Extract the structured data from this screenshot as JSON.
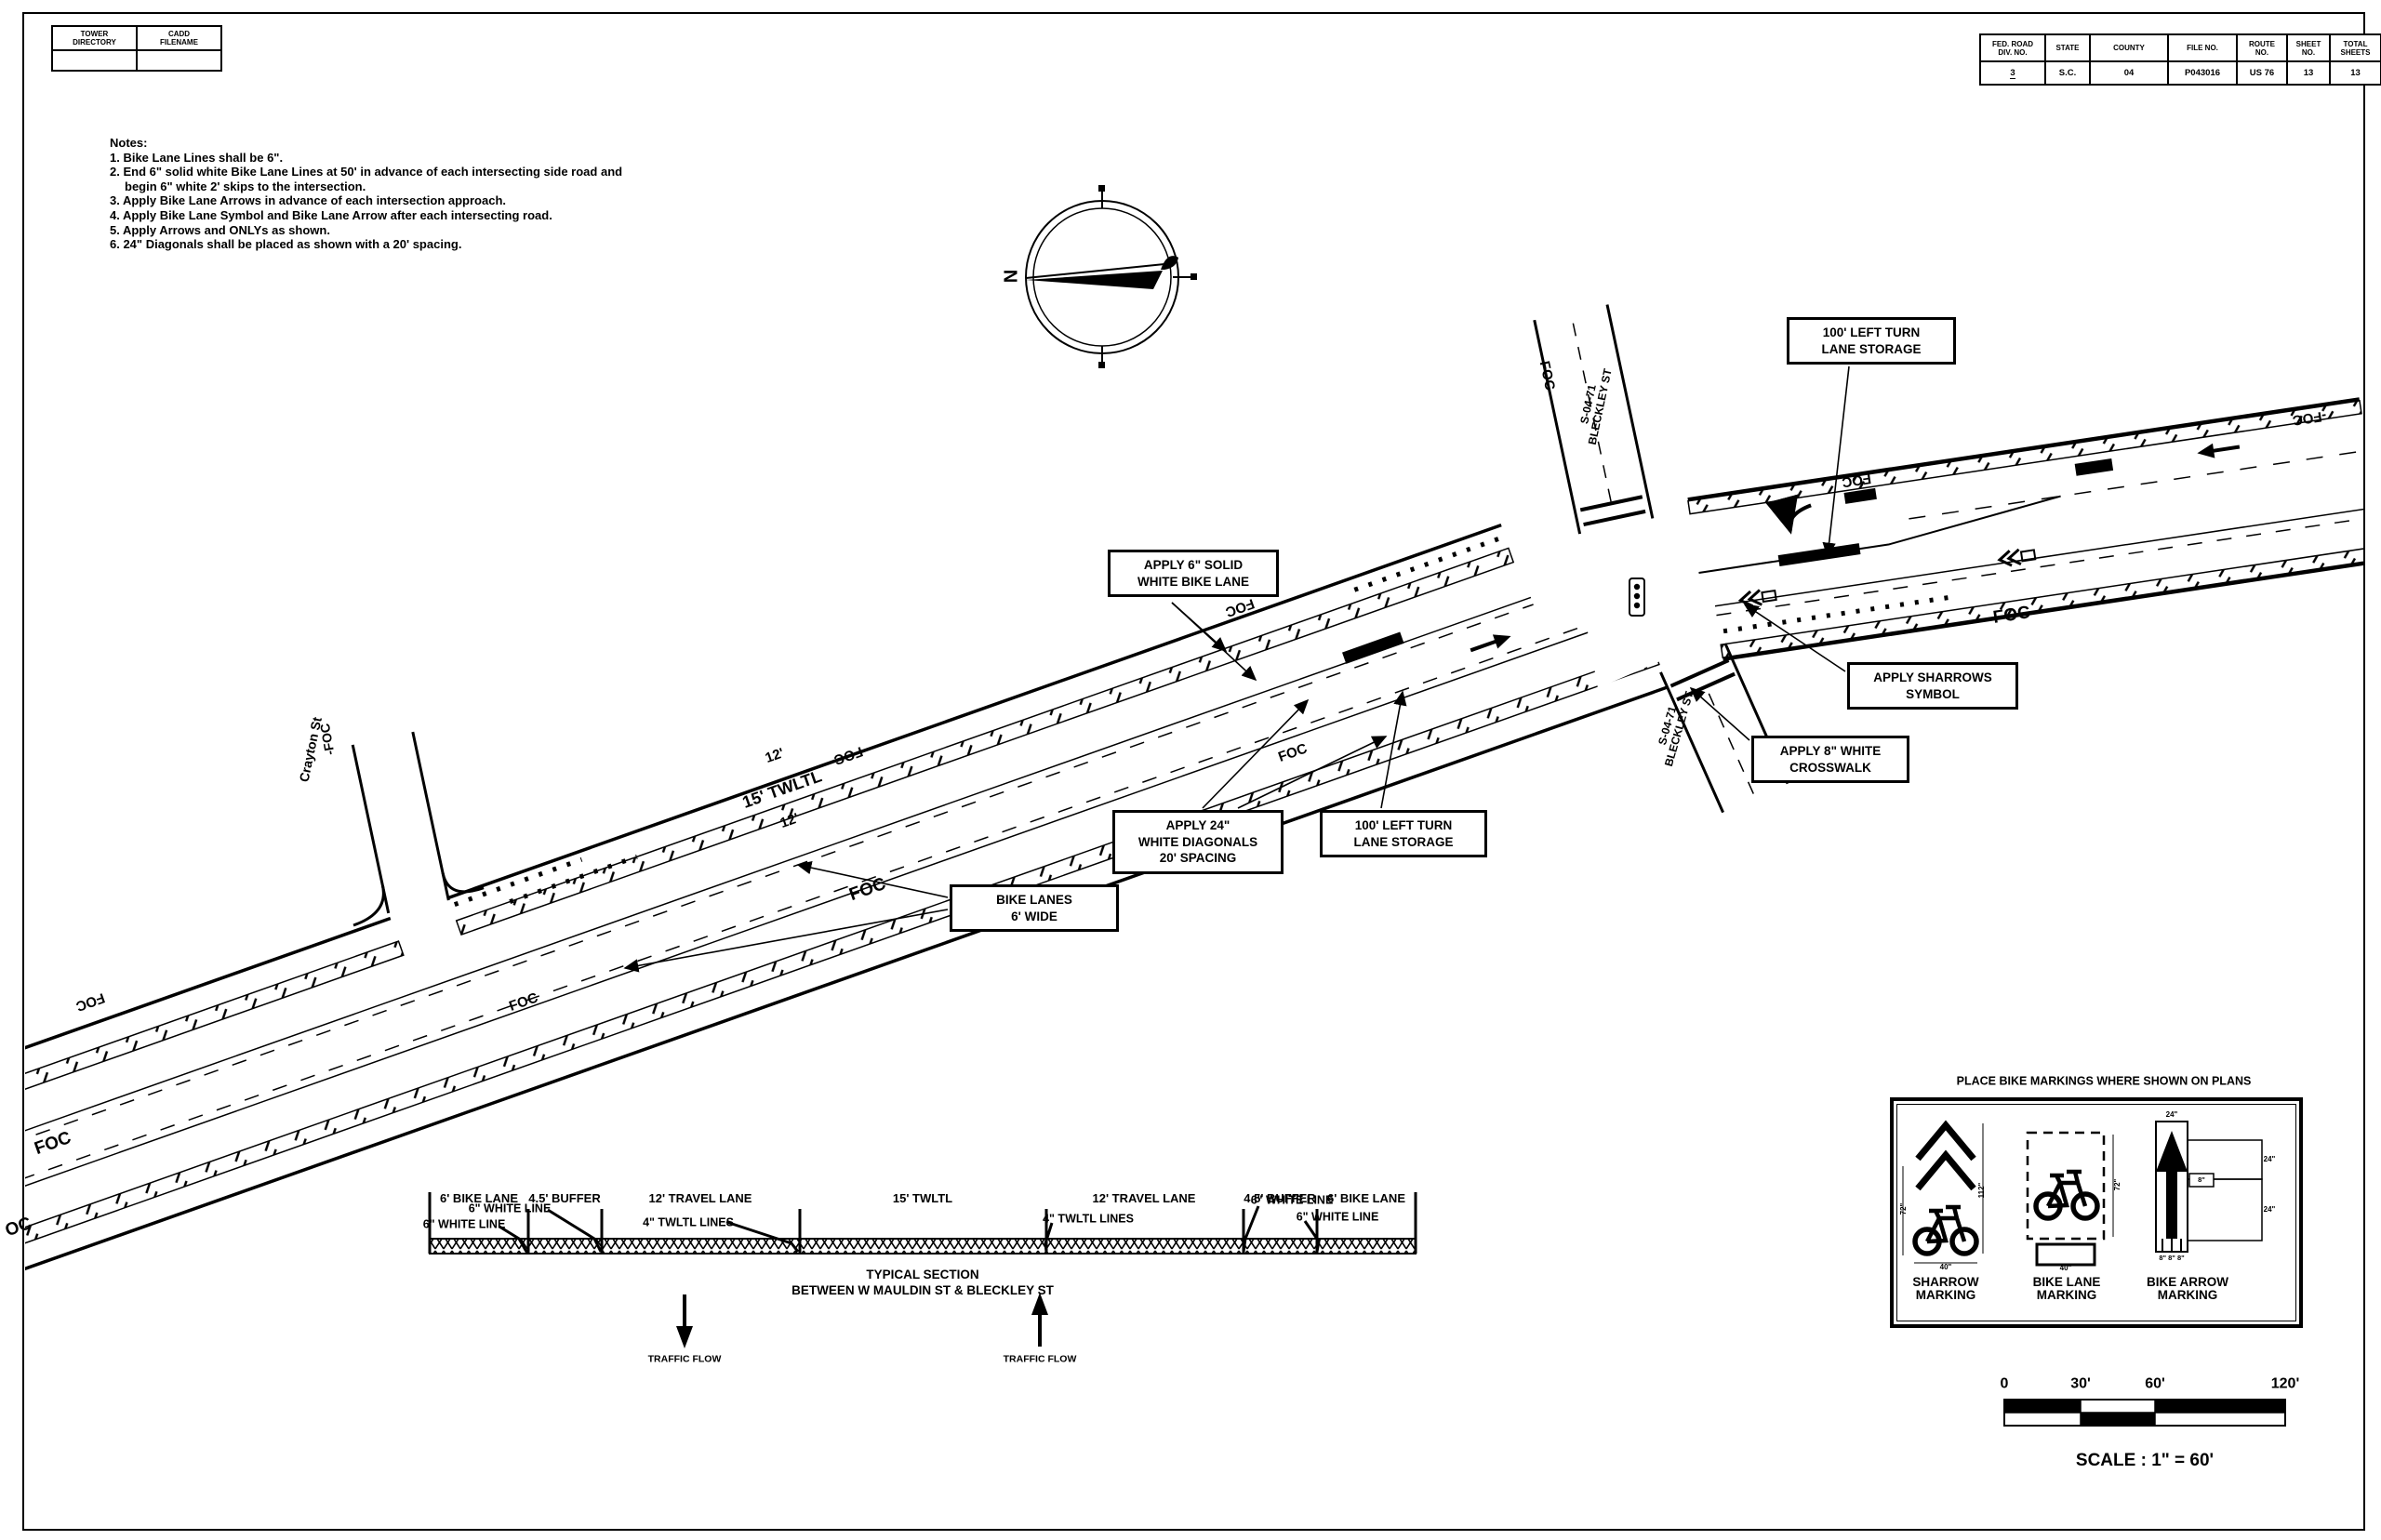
{
  "sheet": {
    "corner_table": {
      "headers": [
        "TOWER\nDIRECTORY",
        "CADD\nFILENAME"
      ]
    },
    "title_block": {
      "columns": [
        {
          "header": "FED. ROAD\nDIV. NO.",
          "value": "3"
        },
        {
          "header": "STATE",
          "value": "S.C."
        },
        {
          "header": "COUNTY",
          "value": "04"
        },
        {
          "header": "FILE NO.",
          "value": "P043016"
        },
        {
          "header": "ROUTE\nNO.",
          "value": "US 76"
        },
        {
          "header": "SHEET\nNO.",
          "value": "13"
        },
        {
          "header": "TOTAL\nSHEETS",
          "value": "13"
        }
      ]
    }
  },
  "notes": {
    "heading": "Notes:",
    "items": [
      "1. Bike Lane Lines shall be 6\".",
      "2. End 6\" solid white Bike Lane Lines at 50' in advance of each intersecting side road and begin 6\" white 2' skips to the intersection.",
      "3. Apply Bike Lane Arrows in advance of each intersection approach.",
      "4. Apply Bike Lane Symbol and Bike Lane Arrow after each intersecting road.",
      "5. Apply Arrows and ONLYs as shown.",
      "6. 24\" Diagonals shall be placed as shown with a 20' spacing."
    ]
  },
  "compass": {
    "north_label": "N"
  },
  "plan": {
    "foc": "FOC",
    "foc_dash": "-FOC",
    "foc_partial": "OC",
    "street_labels": {
      "crayton": "Crayton St",
      "bleckley_top": "S-04-71\nBLECKLEY ST",
      "bleckley_bottom": "S-04-71\nBLECKLEY ST"
    },
    "lane_labels": {
      "top": "12'",
      "middle": "15' TWLTL",
      "bottom": "12'"
    },
    "callouts": {
      "left_turn_storage_ne": "100' LEFT TURN\nLANE STORAGE",
      "solid_white_bike_lane": "APPLY 6\" SOLID\nWHITE BIKE LANE",
      "sharrows": "APPLY SHARROWS\nSYMBOL",
      "crosswalk": "APPLY 8\" WHITE\nCROSSWALK",
      "diagonals": "APPLY 24\"\nWHITE DIAGONALS\n20' SPACING",
      "left_turn_storage_sw": "100' LEFT TURN\nLANE STORAGE",
      "bike_lanes": "BIKE LANES\n6' WIDE"
    }
  },
  "typical_section": {
    "lanes": [
      "6' BIKE LANE",
      "4.5' BUFFER",
      "12' TRAVEL LANE",
      "15' TWLTL",
      "12' TRAVEL LANE",
      "4.5' BUFFER",
      "6' BIKE LANE"
    ],
    "leaders": {
      "left_white_low": "6\" WHITE LINE",
      "left_white_high": "6\" WHITE LINE",
      "left_twltl": "4\" TWLTL LINES",
      "right_twltl": "4\" TWLTL LINES",
      "right_white_high": "6\" WHITE LINE",
      "right_white_low": "6\" WHITE LINE"
    },
    "caption_line1": "TYPICAL SECTION",
    "caption_line2": "BETWEEN W MAULDIN ST & BLECKLEY ST",
    "traffic_flow_left": "TRAFFIC FLOW",
    "traffic_flow_right": "TRAFFIC FLOW"
  },
  "legend": {
    "header": "PLACE BIKE MARKINGS WHERE SHOWN ON PLANS",
    "items": [
      {
        "label": "SHARROW\nMARKING",
        "dims": [
          "72\"",
          "112\"",
          "40\""
        ]
      },
      {
        "label": "BIKE LANE\nMARKING",
        "dims": [
          "72\"",
          "40\""
        ]
      },
      {
        "label": "BIKE ARROW\nMARKING",
        "dims": [
          "24\"",
          "24\"",
          "24\"",
          "8\"",
          "8\" 8\" 8\""
        ]
      }
    ]
  },
  "scale_bar": {
    "ticks": [
      "0",
      "30'",
      "60'",
      "120'"
    ],
    "caption": "SCALE :  1\" = 60'"
  }
}
